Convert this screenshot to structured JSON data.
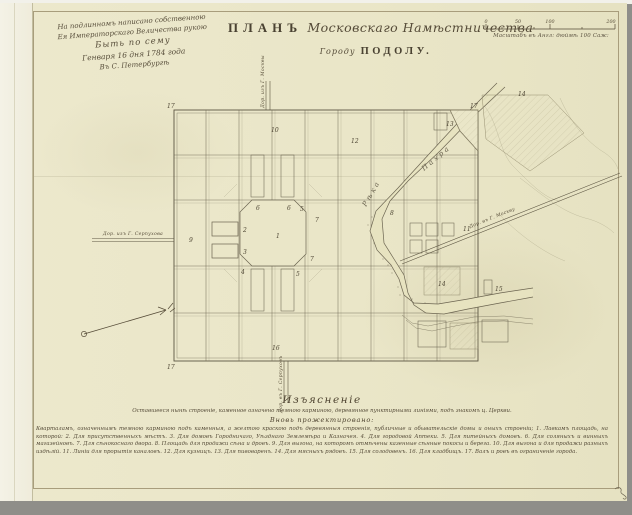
{
  "attestation": {
    "lines": [
      "На подлинномъ написано собственною",
      "Ея Императорскаго Величества рукою",
      "Быть по сему",
      "Генваря 16 дня 1784 года",
      "Въ С. Петербургѣ"
    ]
  },
  "title": {
    "word": "ПЛАНЪ",
    "script": "Московскаго Намѣстничества",
    "sub_prefix": "Городу",
    "sub_main": "ПОДОЛУ."
  },
  "scale_bar": {
    "ticks": [
      "0",
      "50",
      "100",
      "200"
    ],
    "caption": "Масштабъ въ Англ: дюймѣ 100 Саж:"
  },
  "map": {
    "river_label_upper": "Пахра",
    "river_label_lower": "Рѣка",
    "roads": {
      "left": "Дор. изъ Г. Серпухова",
      "top": "Дор. изъ Г. Москвы",
      "bottom": "Дор. въ Г. Серпуховъ",
      "right": "Дор. въ Г. Москву"
    },
    "numbers": [
      "17",
      "17",
      "17",
      "10",
      "16",
      "9",
      "1",
      "2",
      "3",
      "4",
      "5",
      "5",
      "6",
      "6",
      "7",
      "7",
      "8",
      "11",
      "12",
      "13",
      "14",
      "14",
      "15"
    ]
  },
  "legend": {
    "heading": "Изъясненіе",
    "intro": "Оставшееся нынѣ строеніе, каменное означено темною карминою, деревянное пунктирными линіями, подъ знакомъ ц. Церкви.",
    "subheading": "Вновь прожектировано:",
    "body": "Кварталамъ, означеннымъ темною карминою подъ каменныя, а желтою краскою подъ деревянныя строенія, публичные и обывательскіе домы и оныхъ строеніи; 1. Лавкамъ площадь, на которой: 2. Для присутственныхъ мѣстъ. 3. Для домовъ Городничаго, Уѣзднаго Землемѣра и Казначея. 4. Для городовой Аптеки. 5. Для питейныхъ домовъ. 6. Для соляныхъ и винныхъ магазейновъ. 7. Для сѣнокоснаго двора. 8. Площадь для продажи сѣна и дровъ. 9. Для выгона, на которомъ отмѣчены казенные сѣнные покосы и берега. 10. Для выгона и для продажи разныхъ издѣлій. 11. Линіи для прорытія каналовъ. 12. Для кузницъ. 13. Для пивоваренъ. 14. Для мясныхъ рядовъ. 15. Для солодовенъ. 16. Для кладбищъ. 17. Валъ и ровъ въ ограниченіе города."
  }
}
